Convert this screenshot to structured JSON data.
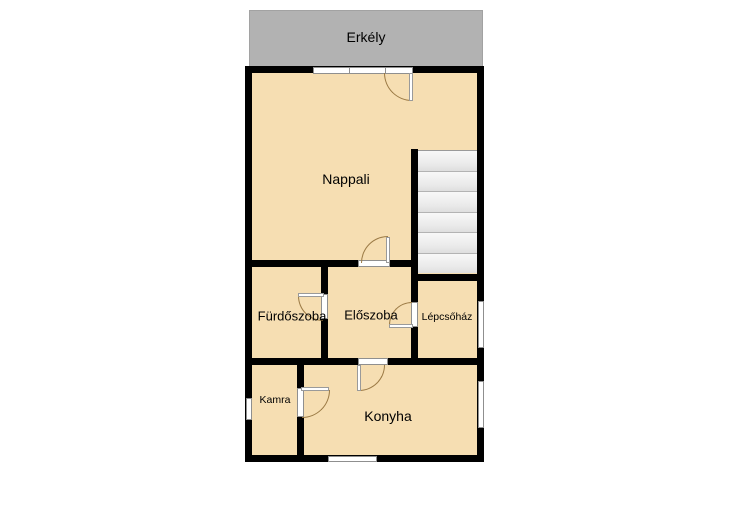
{
  "floorplan": {
    "balcony": {
      "label": "Erkély"
    },
    "rooms": {
      "nappali": {
        "label": "Nappali"
      },
      "furdoszoba": {
        "label": "Fürdőszoba"
      },
      "eloszoba": {
        "label": "Előszoba"
      },
      "lepcsohaz": {
        "label": "Lépcsőház"
      },
      "kamra": {
        "label": "Kamra"
      },
      "konyha": {
        "label": "Konyha"
      }
    },
    "colors": {
      "room_fill": "#f6deb2",
      "wall": "#000000",
      "balcony_fill": "#b2b2b2",
      "stairs_fill": "#ececec",
      "window_fill": "#ffffff",
      "door_arc": "#9b7a45",
      "background": "#ffffff"
    }
  }
}
